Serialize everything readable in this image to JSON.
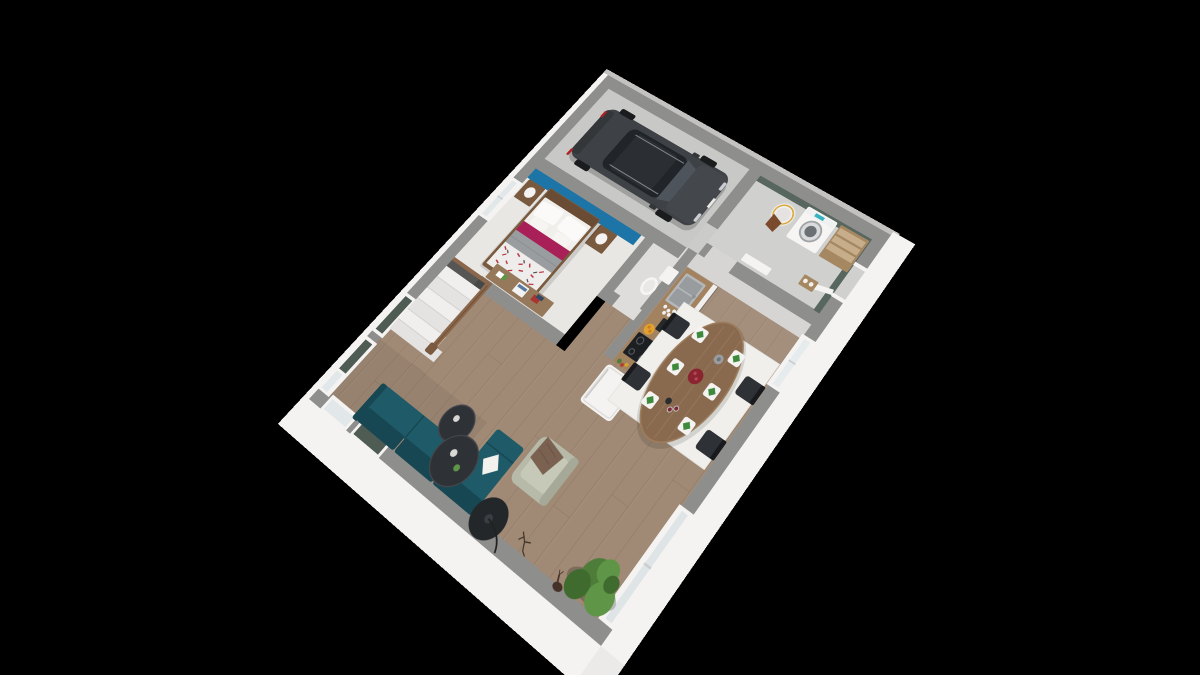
{
  "scene": {
    "type": "3d-floor-plan-render",
    "view": "isometric-top-down",
    "background": "#000000"
  },
  "palette": {
    "bg": "#000000",
    "wallTop": "#8e8e8c",
    "wallFaceWhite": "#f4f3f1",
    "lipGray": "#c3c2c0",
    "woodFloor": "#a08a75",
    "garageFloor": "#c8c8c6",
    "laundryFloor": "#d0d0ce",
    "hallTile": "#d6d5d3",
    "bedroomFloor": "#e9e7e4",
    "wcFloor": "#dedddb",
    "accentBlue": "#1d74a6",
    "accentSage": "#57665f",
    "shutterSage": "#4e5c54",
    "sofaTeal": "#1e5a68",
    "sofaTealDark": "#174752",
    "armchairSage": "#b7baa9",
    "throwBrown": "#7b6250",
    "tableBlack": "#2e3236",
    "carBody": "#3e4145",
    "carGlass": "#212428",
    "bedWood": "#7a5a3e",
    "duvetMagenta": "#a82057",
    "blanketGray": "#9a9da0",
    "patternRed": "#b73340",
    "diningWood": "#8a6a4e",
    "rugWhite": "#f0efeb",
    "counterWood": "#a3825f",
    "cabinetWhite": "#f0efed",
    "steel": "#b4b7ba",
    "applianceBlack": "#1d2023",
    "fridgeWhite": "#f4f3f1",
    "washerTeal": "#35b3c2",
    "basketBrown": "#7a4a2c",
    "shelfWood": "#a58862",
    "stairRailWood": "#8a674a",
    "stepWhite": "#f0efed",
    "plantGreen": "#4e7d3a",
    "plantGreenLight": "#5f9546",
    "plantGreenDark": "#3f6b2e",
    "fruitOrange": "#e3a02f",
    "napkinGreen": "#3e8a3c",
    "berryRed": "#8a2430",
    "deerBrown": "#453128",
    "lampBlack": "#24272a"
  },
  "objects": [
    "car",
    "double-bed",
    "nightstands",
    "bedside-lamps",
    "desk",
    "staircase",
    "toilet",
    "kitchen-counter",
    "sink",
    "cooktop",
    "coffee-machine",
    "fruit-bowl",
    "fridge",
    "dining-table",
    "dining-chairs",
    "place-settings",
    "white-rug",
    "sofa",
    "coffee-tables",
    "armchair",
    "floor-lamp",
    "throw-blanket",
    "washing-machine",
    "laundry-basket",
    "storage-shelf",
    "pet-bowls",
    "corner-plant",
    "deer-figurine",
    "branch-decor"
  ]
}
